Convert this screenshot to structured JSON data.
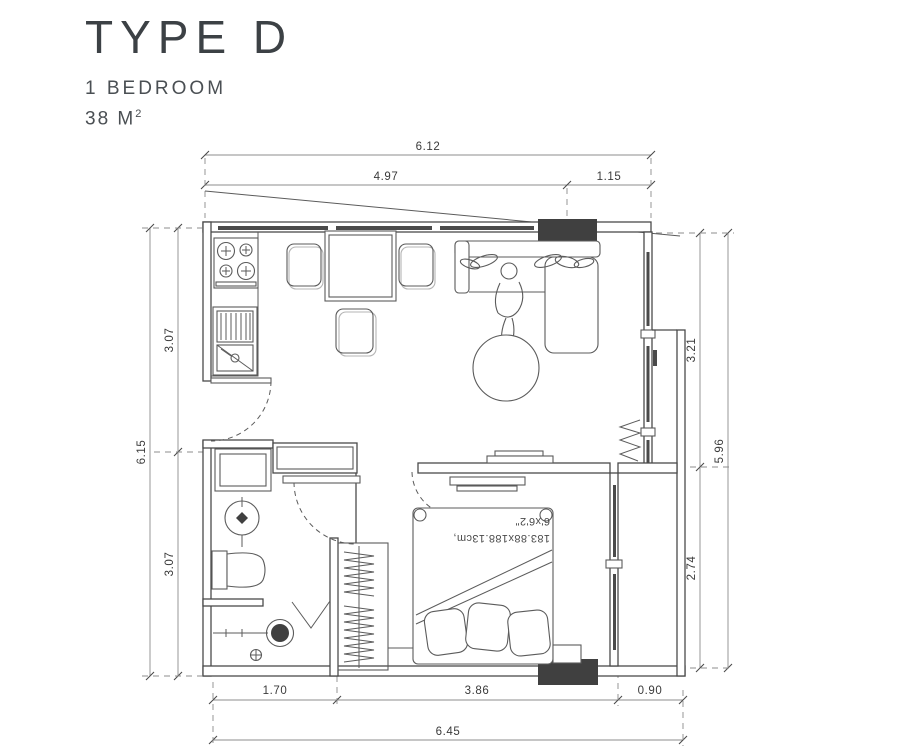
{
  "header": {
    "title": "TYPE D",
    "subtitle": "1 BEDROOM",
    "area": "38 M",
    "area_sup": "2"
  },
  "dimensions": {
    "top_total": "6.12",
    "top_left": "4.97",
    "top_right": "1.15",
    "left_upper": "3.07",
    "left_lower": "3.07",
    "left_total": "6.15",
    "right_upper": "3.21",
    "right_lower": "2.74",
    "right_total": "5.96",
    "bottom_left": "1.70",
    "bottom_middle": "3.86",
    "bottom_right": "0.90",
    "bottom_total": "6.45"
  },
  "bed": {
    "size_metric": "183.88x188.13cm,",
    "size_imperial": "6'x6'2\""
  },
  "colors": {
    "line": "#4a4a4a",
    "dark_fill": "#404040",
    "dim_line": "#8c8c8c",
    "title_text": "#3c4145"
  }
}
